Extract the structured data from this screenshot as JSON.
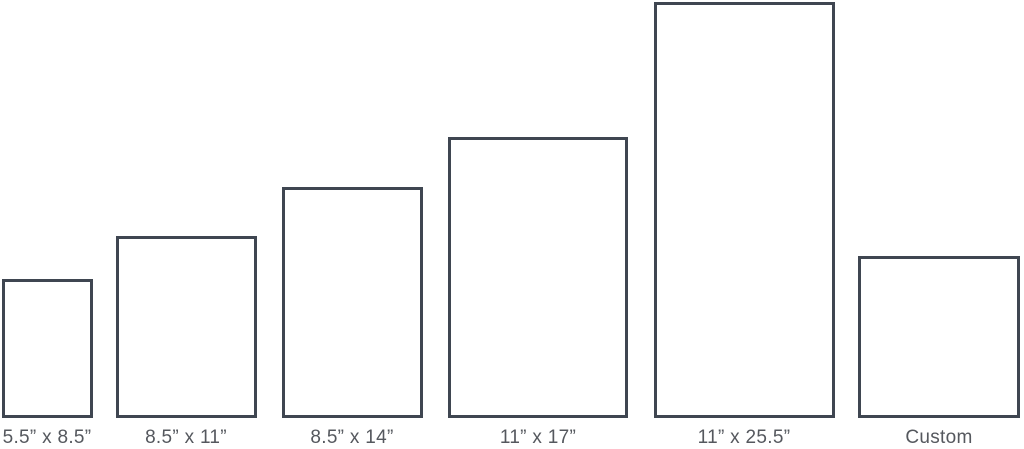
{
  "colors": {
    "background": "#ffffff",
    "rect_border": "#3f4651",
    "label_text": "#55585e"
  },
  "sizes": [
    {
      "label": "5.5” x 8.5”"
    },
    {
      "label": "8.5” x 11”"
    },
    {
      "label": "8.5” x 14”"
    },
    {
      "label": "11” x 17”"
    },
    {
      "label": "11” x 25.5”"
    },
    {
      "label": "Custom"
    }
  ]
}
